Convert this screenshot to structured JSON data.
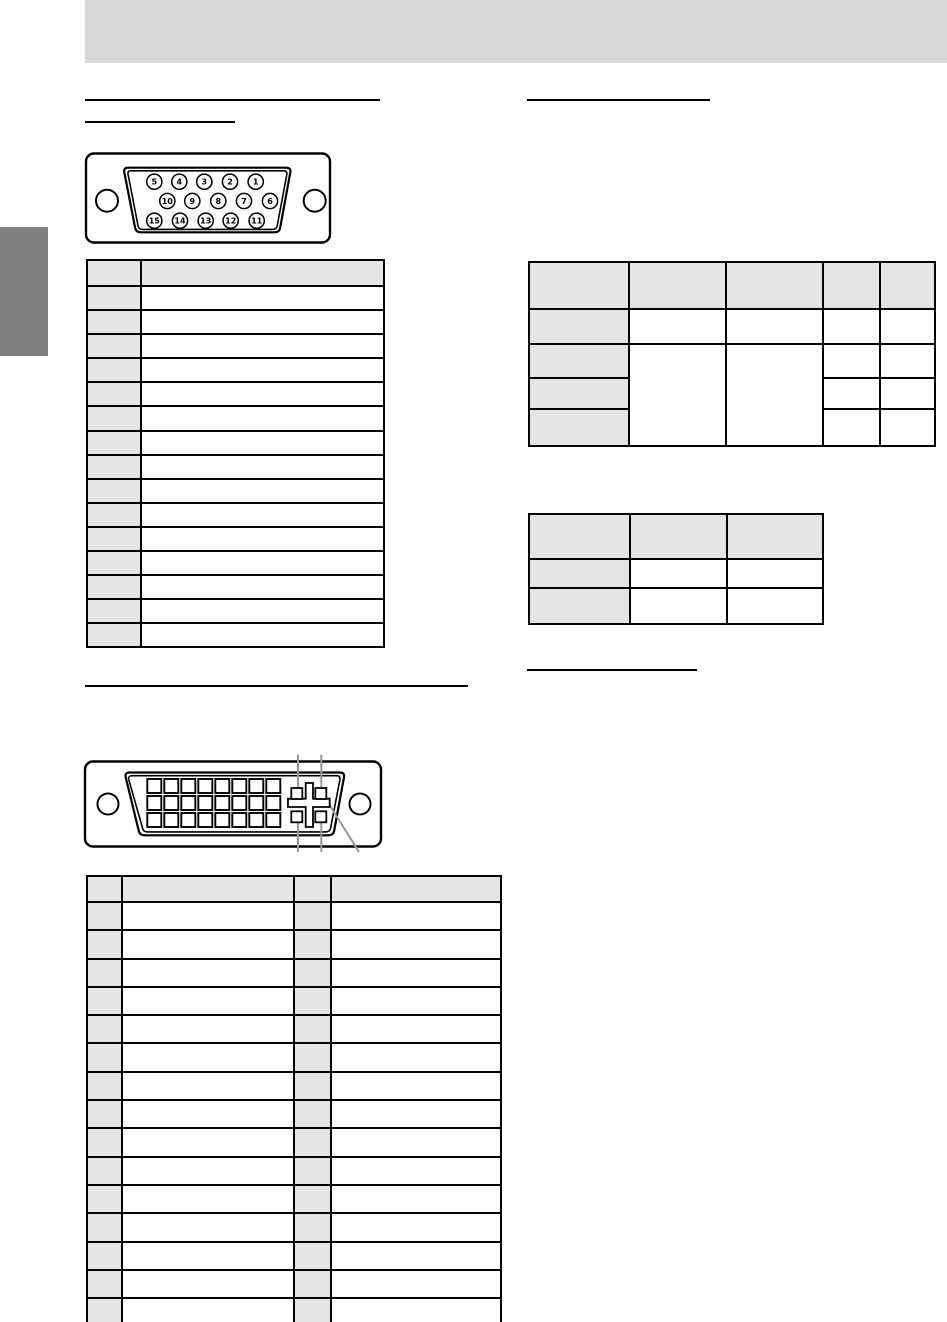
{
  "page": {
    "background": "#ffffff"
  },
  "header_bar": {
    "color": "#d8d8d8"
  },
  "side_tab": {
    "color": "#7f7f7f"
  },
  "colors": {
    "table_header_fill": "#e4e4e4",
    "table_border": "#000000",
    "callout_line": "#999999",
    "line_art": "#000000"
  },
  "headings": {
    "left_primary_text": "",
    "left_secondary_text": "",
    "right_primary_text": "",
    "right_secondary_text": "",
    "dvi_section_text": ""
  },
  "vga_connector": {
    "pin_rows": [
      [
        "5",
        "4",
        "3",
        "2",
        "1"
      ],
      [
        "10",
        "9",
        "8",
        "7",
        "6"
      ],
      [
        "15",
        "14",
        "13",
        "12",
        "11"
      ]
    ]
  },
  "dvi_connector": {
    "pin_grid": {
      "rows": 3,
      "cols": 8
    },
    "corner_pin_count": 4
  },
  "tables": {
    "vga_pins": {
      "columns": 2,
      "data_rows": 15,
      "cell_text": ""
    },
    "sync_signal": {
      "columns": 5,
      "cell_text": ""
    },
    "signal_small": {
      "columns": 3,
      "data_rows": 2,
      "cell_text": ""
    },
    "dvi_pins": {
      "columns": 4,
      "data_rows": 15,
      "cell_text": ""
    }
  }
}
